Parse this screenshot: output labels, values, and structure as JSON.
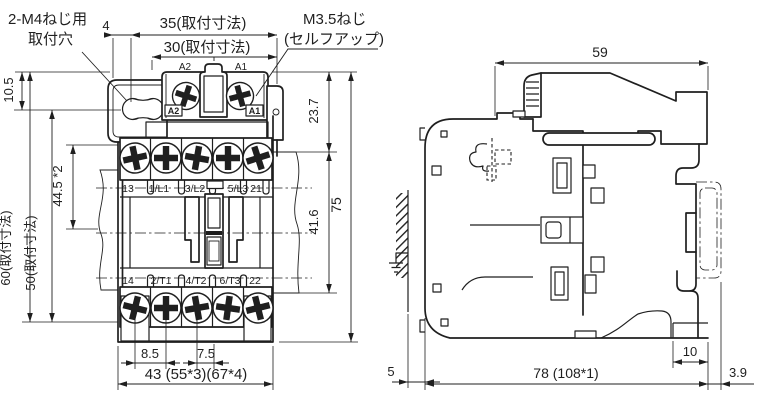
{
  "front_view": {
    "notes": {
      "mounting_hole_1": "2-M4ねじ用",
      "mounting_hole_2": "取付穴",
      "screw_1": "M3.5ねじ",
      "screw_2": "(セルフアップ)"
    },
    "coil_terminals": {
      "left": "A2",
      "right": "A1",
      "left_boxed": "A2",
      "right_boxed": "A1"
    },
    "top_row": [
      "13",
      "1/L1",
      "3/L2",
      "5/L3",
      "21"
    ],
    "bottom_row": [
      "14",
      "2/T1",
      "4/T2",
      "6/T3",
      "22"
    ],
    "dims": {
      "offset_4": "4",
      "width_35": "35(取付寸法)",
      "width_30": "30(取付寸法)",
      "height_10_5": "10.5",
      "height_60": "60(取付寸法)",
      "height_50": "50(取付寸法)",
      "height_44_5": "44.5 *2",
      "height_23_7": "23.7",
      "height_41_6": "41.6",
      "height_75": "75",
      "pitch_8_5": "8.5",
      "pitch_7_5": "7.5",
      "width_43": "43 (55*3)(67*4)"
    }
  },
  "side_view": {
    "dims": {
      "width_59": "59",
      "depth_10": "10",
      "depth_78": "78 (108*1)",
      "rail_3_9": "3.9",
      "gap_5": "5"
    }
  },
  "colors": {
    "line": "#1f1f1f",
    "background": "#ffffff"
  }
}
